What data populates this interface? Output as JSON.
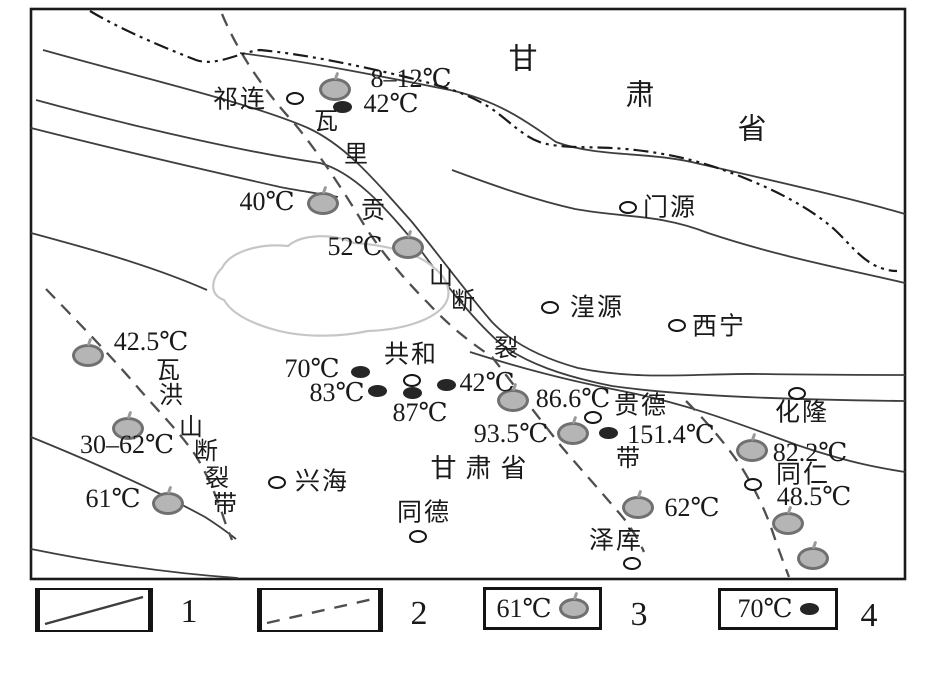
{
  "figure": {
    "width": 940,
    "height": 684
  },
  "colors": {
    "ink": "#1a1a1a",
    "line": "#3e3e3e",
    "boundary": "#111111",
    "fault_dashed": "#4f4f4f",
    "lake_outline": "#c6c6c6",
    "spring_fill": "#b5b5b5",
    "spring_ring": "#707070",
    "vent_fill": "#262626",
    "city_fill": "#ffffff",
    "background": "#ffffff"
  },
  "province_chars": [
    {
      "t": "甘",
      "x": 523,
      "y": 60
    },
    {
      "t": "肃",
      "x": 640,
      "y": 96
    },
    {
      "t": "省",
      "x": 752,
      "y": 130
    }
  ],
  "region_label": {
    "t": "甘肃省",
    "x": 483,
    "y": 469
  },
  "cities": [
    {
      "name": "祁连",
      "cx": 295,
      "cy": 98,
      "lx": 240,
      "ly": 100
    },
    {
      "name": "门源",
      "cx": 628,
      "cy": 207,
      "lx": 670,
      "ly": 208
    },
    {
      "name": "湟源",
      "cx": 550,
      "cy": 307,
      "lx": 597,
      "ly": 308
    },
    {
      "name": "西宁",
      "cx": 677,
      "cy": 325,
      "lx": 719,
      "ly": 327
    },
    {
      "name": "共和",
      "cx": 412,
      "cy": 380,
      "lx": 411,
      "ly": 355
    },
    {
      "name": "贵德",
      "cx": 593,
      "cy": 417,
      "lx": 641,
      "ly": 406
    },
    {
      "name": "兴海",
      "cx": 277,
      "cy": 482,
      "lx": 322,
      "ly": 482
    },
    {
      "name": "同德",
      "cx": 418,
      "cy": 536,
      "lx": 424,
      "ly": 513
    },
    {
      "name": "泽库",
      "cx": 632,
      "cy": 563,
      "lx": 616,
      "ly": 541
    },
    {
      "name": "同仁",
      "cx": 753,
      "cy": 484,
      "lx": 803,
      "ly": 475
    },
    {
      "name": "化隆",
      "cx": 797,
      "cy": 393,
      "lx": 802,
      "ly": 413
    }
  ],
  "hot_springs": [
    {
      "temp": "8–12℃",
      "cx": 335,
      "cy": 89,
      "lx": 411,
      "ly": 79
    },
    {
      "temp": "40℃",
      "cx": 323,
      "cy": 203,
      "lx": 267,
      "ly": 202
    },
    {
      "temp": "52℃",
      "cx": 408,
      "cy": 247,
      "lx": 355,
      "ly": 247
    },
    {
      "temp": "42.5℃",
      "cx": 88,
      "cy": 355,
      "lx": 151,
      "ly": 342
    },
    {
      "temp": "30–62℃",
      "cx": 128,
      "cy": 428,
      "lx": 127,
      "ly": 445
    },
    {
      "temp": "61℃",
      "cx": 168,
      "cy": 503,
      "lx": 113,
      "ly": 499
    },
    {
      "temp": "86.6℃",
      "cx": 513,
      "cy": 400,
      "lx": 573,
      "ly": 399
    },
    {
      "temp": "93.5℃",
      "cx": 573,
      "cy": 433,
      "lx": 511,
      "ly": 434
    },
    {
      "temp": "82.2℃",
      "cx": 752,
      "cy": 450,
      "lx": 810,
      "ly": 453
    },
    {
      "temp": "62℃",
      "cx": 638,
      "cy": 507,
      "lx": 692,
      "ly": 508
    },
    {
      "temp": "48.5℃",
      "cx": 788,
      "cy": 523,
      "lx": 814,
      "ly": 497
    },
    {
      "temp": "",
      "cx": 813,
      "cy": 558,
      "lx": 0,
      "ly": 0
    }
  ],
  "hot_vents": [
    {
      "temp": "42℃",
      "cx": 342,
      "cy": 107,
      "lx": 391,
      "ly": 104
    },
    {
      "temp": "70℃",
      "cx": 360,
      "cy": 372,
      "lx": 312,
      "ly": 369
    },
    {
      "temp": "83℃",
      "cx": 377,
      "cy": 391,
      "lx": 337,
      "ly": 393
    },
    {
      "temp": "87℃",
      "cx": 412,
      "cy": 393,
      "lx": 420,
      "ly": 413
    },
    {
      "temp": "42℃",
      "cx": 446,
      "cy": 385,
      "lx": 487,
      "ly": 383
    },
    {
      "temp": "151.4℃",
      "cx": 608,
      "cy": 433,
      "lx": 671,
      "ly": 435
    }
  ],
  "fault_names": [
    {
      "fault": "wariggongshan-fault-zone",
      "chars": [
        {
          "t": "瓦",
          "x": 326,
          "y": 122
        },
        {
          "t": "里",
          "x": 356,
          "y": 155
        },
        {
          "t": "贡",
          "x": 373,
          "y": 211
        },
        {
          "t": "山",
          "x": 441,
          "y": 277
        },
        {
          "t": "断",
          "x": 463,
          "y": 302
        },
        {
          "t": "裂",
          "x": 506,
          "y": 349
        },
        {
          "t": "带",
          "x": 628,
          "y": 459
        }
      ]
    },
    {
      "fault": "wahongshan-fault-zone",
      "chars": [
        {
          "t": "瓦",
          "x": 168,
          "y": 371
        },
        {
          "t": "洪",
          "x": 171,
          "y": 396
        },
        {
          "t": "山",
          "x": 191,
          "y": 428
        },
        {
          "t": "断",
          "x": 206,
          "y": 452
        },
        {
          "t": "裂",
          "x": 217,
          "y": 479
        },
        {
          "t": "带",
          "x": 225,
          "y": 505
        }
      ]
    }
  ],
  "legend": {
    "items": [
      {
        "num": "1",
        "type": "solid-line"
      },
      {
        "num": "2",
        "type": "dashed-line"
      },
      {
        "num": "3",
        "type": "hot-spring",
        "text": "61℃"
      },
      {
        "num": "4",
        "type": "hot-vent",
        "text": "70℃"
      }
    ]
  }
}
